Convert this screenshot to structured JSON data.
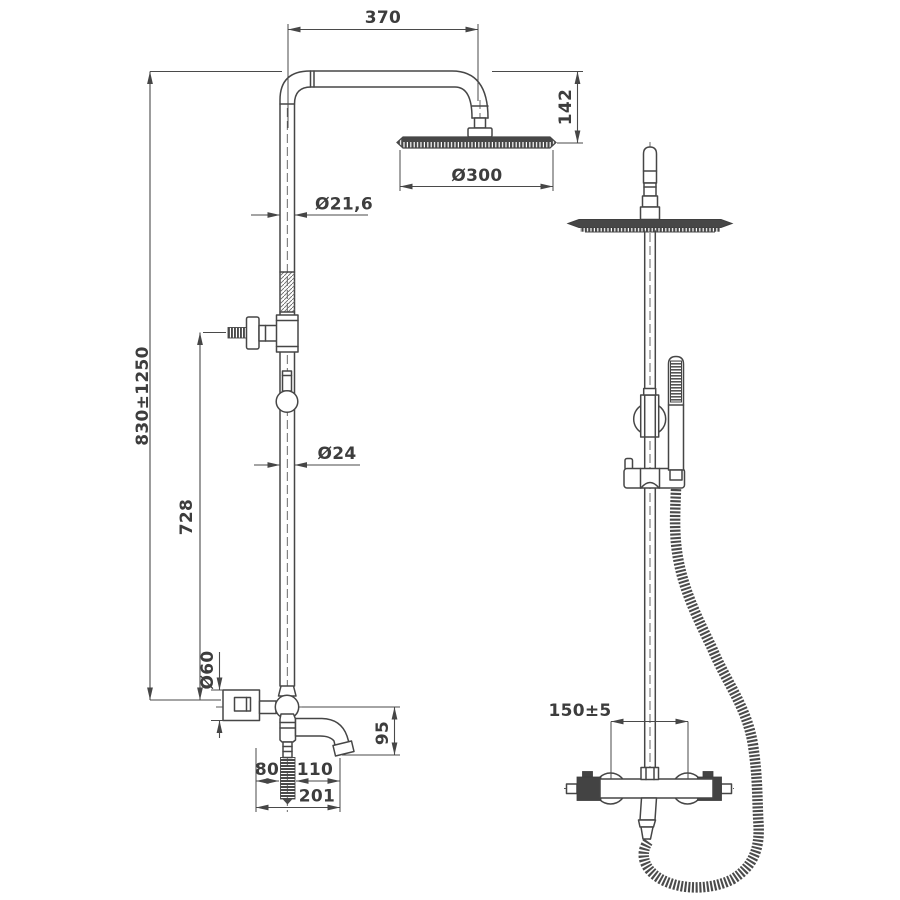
{
  "drawing": {
    "dimensions": {
      "arm_width": "370",
      "head_drop": "142",
      "head_diameter": "Ø300",
      "upper_pipe_diameter": "Ø21,6",
      "column_height_range": "830±1250",
      "lower_column_height": "728",
      "lower_pipe_diameter": "Ø24",
      "flange_diameter": "Ø60",
      "spout_drop": "95",
      "wall_to_hose_center": "80",
      "hose_center_to_spout_tip": "110",
      "wall_to_spout_tip": "201",
      "valve_center_distance": "150±5"
    },
    "colors": {
      "line": "#464646",
      "dimension_line": "#4a4a4a",
      "text": "#3d3d3d",
      "dark_fill": "#434343",
      "background": "#ffffff"
    }
  }
}
